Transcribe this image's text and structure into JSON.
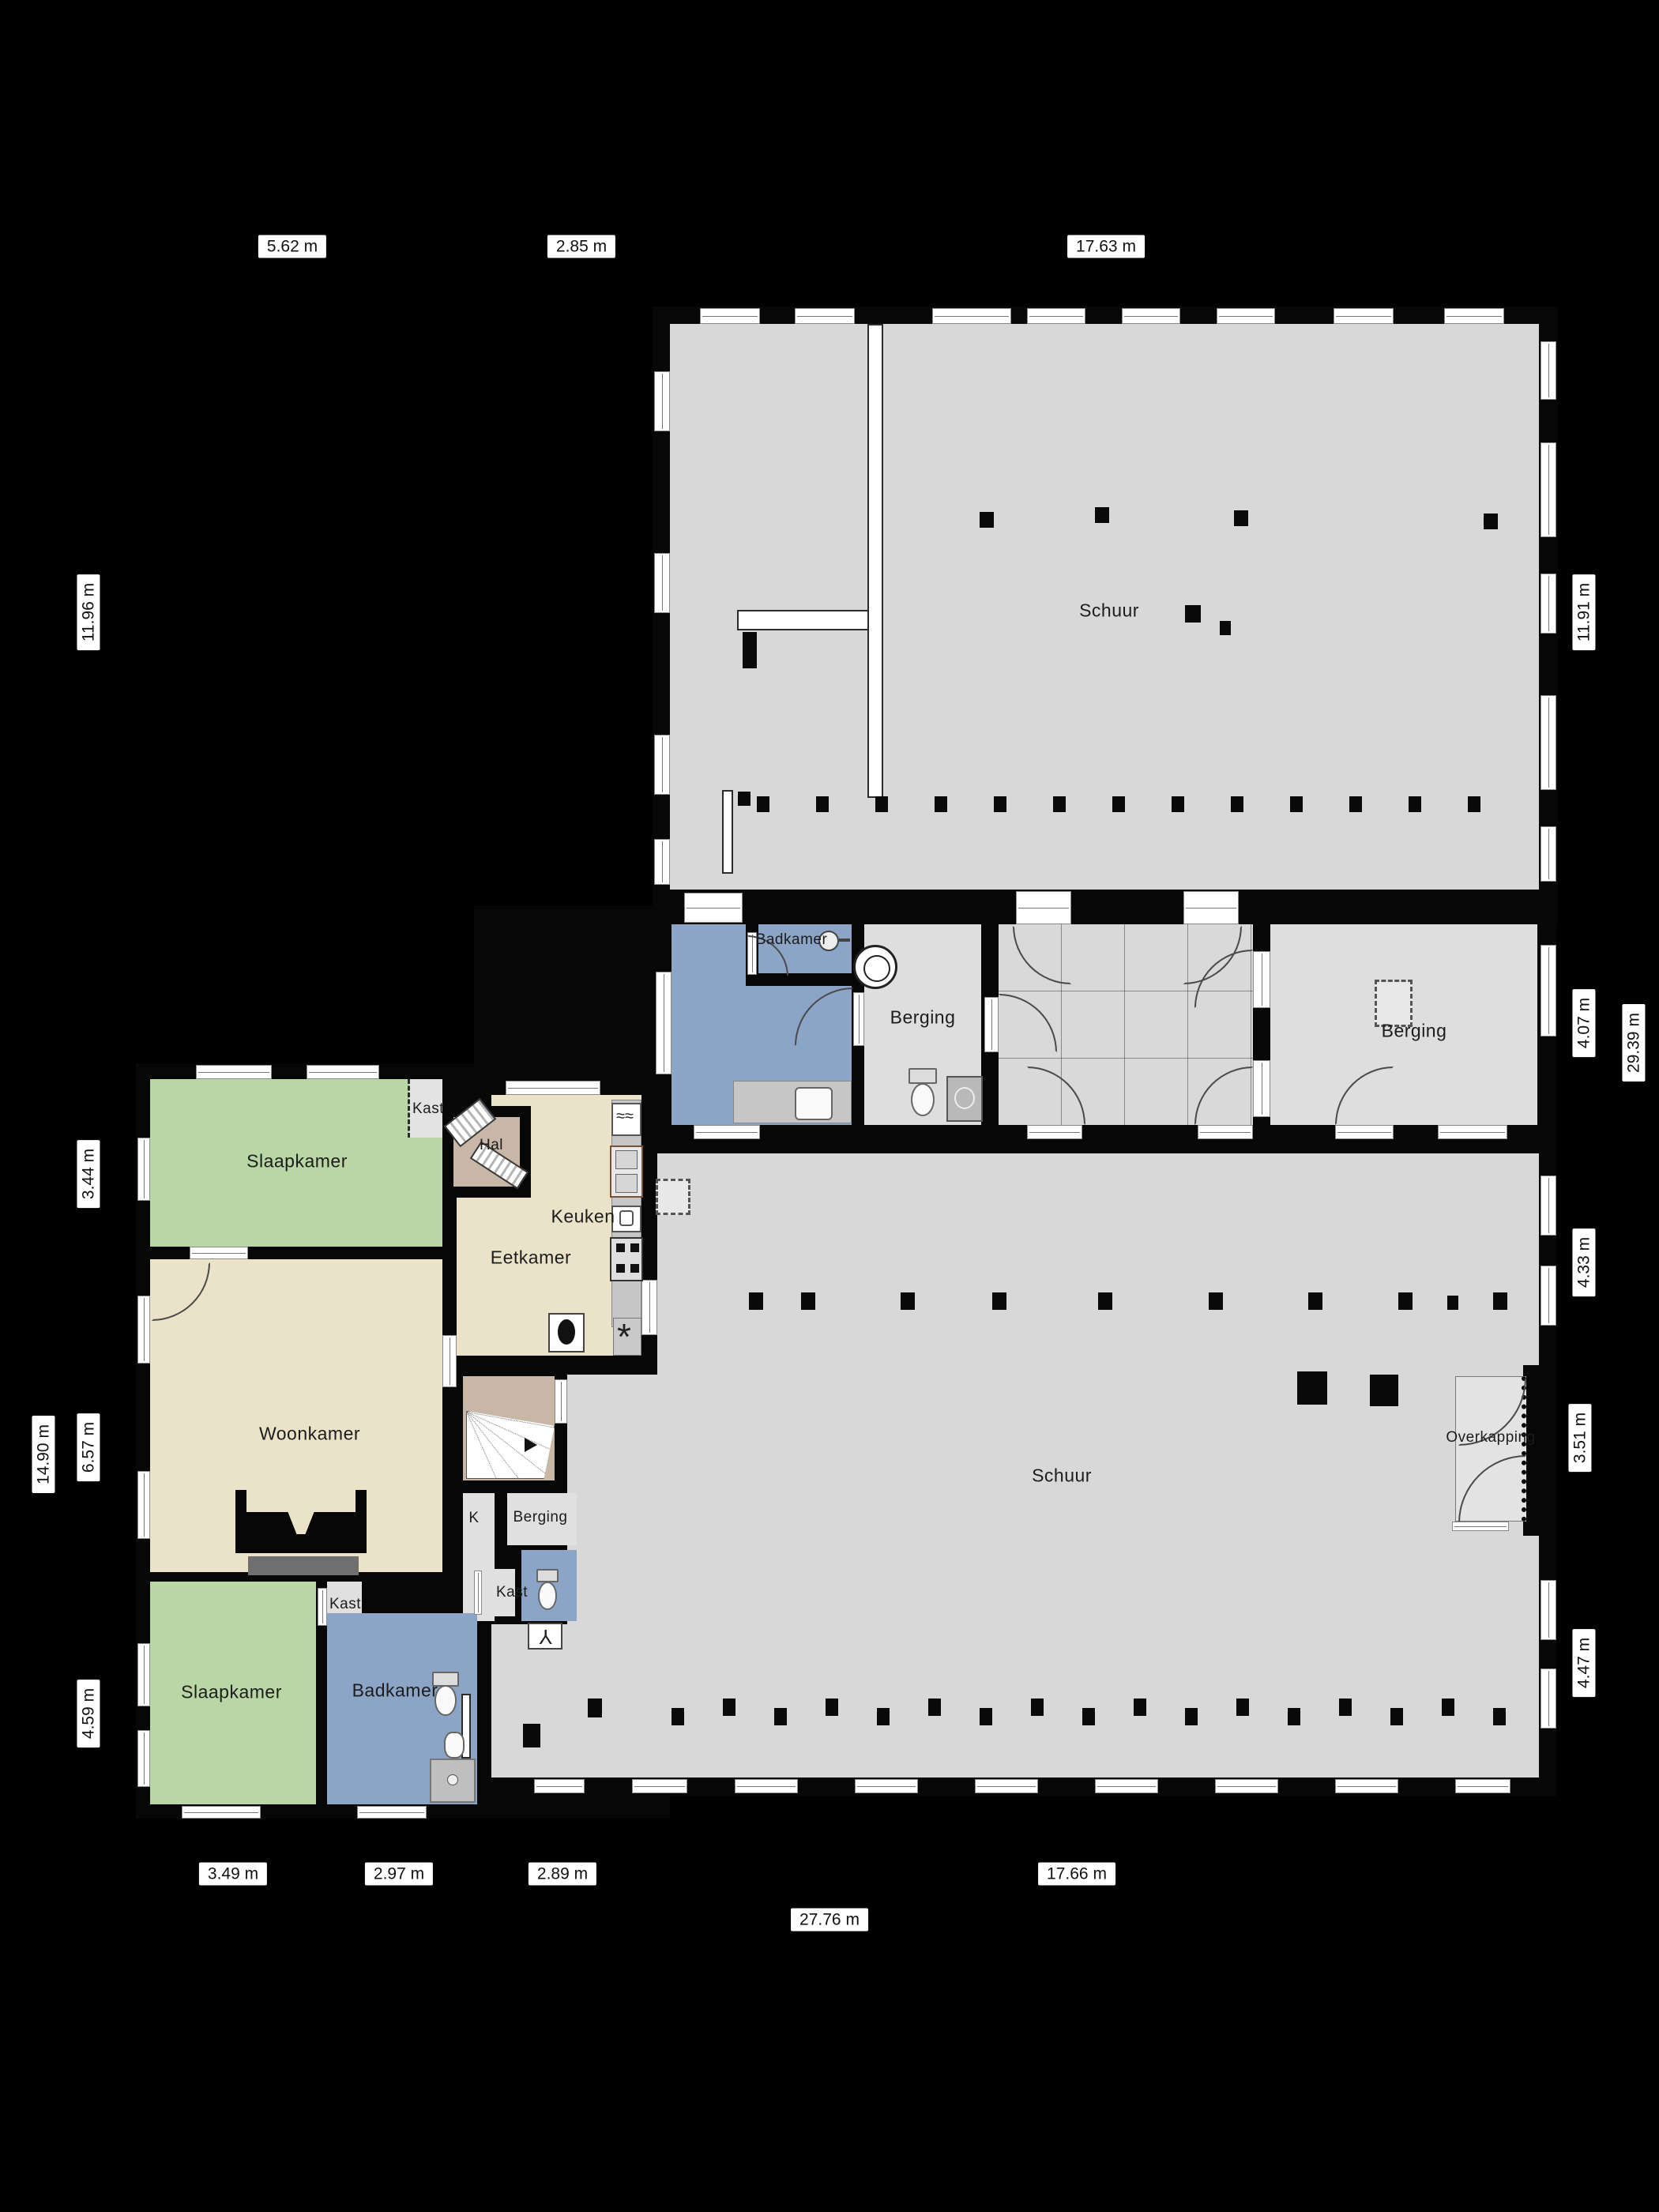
{
  "rooms": {
    "schuur_top": "Schuur",
    "badkamer_mid": "Badkamer",
    "berging_mid_left": "Berging",
    "berging_mid_right": "Berging",
    "schuur_bottom": "Schuur",
    "overkapping": "Overkapping",
    "slaapkamer_1": "Slaapkamer",
    "kast_1": "Kast",
    "hal": "Hal",
    "keuken": "Keuken",
    "eetkamer": "Eetkamer",
    "woonkamer": "Woonkamer",
    "k_abbrev": "K",
    "berging_house": "Berging",
    "kast_sliding": "Kast",
    "kast_2": "Kast",
    "slaapkamer_2": "Slaapkamer",
    "badkamer_2": "Badkamer"
  },
  "dimensions": {
    "top": [
      "5.62 m",
      "2.85 m",
      "17.63 m"
    ],
    "left": [
      "11.96 m",
      "3.44 m",
      "6.57 m",
      "14.90 m",
      "4.59 m"
    ],
    "right": [
      "11.91 m",
      "4.07 m",
      "29.39 m",
      "4.33 m",
      "3.51 m",
      "4.47 m"
    ],
    "bottom": [
      "3.49 m",
      "2.97 m",
      "2.89 m",
      "17.66 m",
      "27.76 m"
    ]
  },
  "icons": {
    "heater_glyph": "*",
    "tap_glyph": "Y"
  },
  "colors": {
    "shed": "#d8d8d8",
    "storage": "#dedede",
    "bedroom": "#b9d7a4",
    "living": "#ebe3c9",
    "bath": "#8ca5c7",
    "hall": "#c8b6a6",
    "wall": "#070707",
    "hearth": "#6f6f6f"
  }
}
